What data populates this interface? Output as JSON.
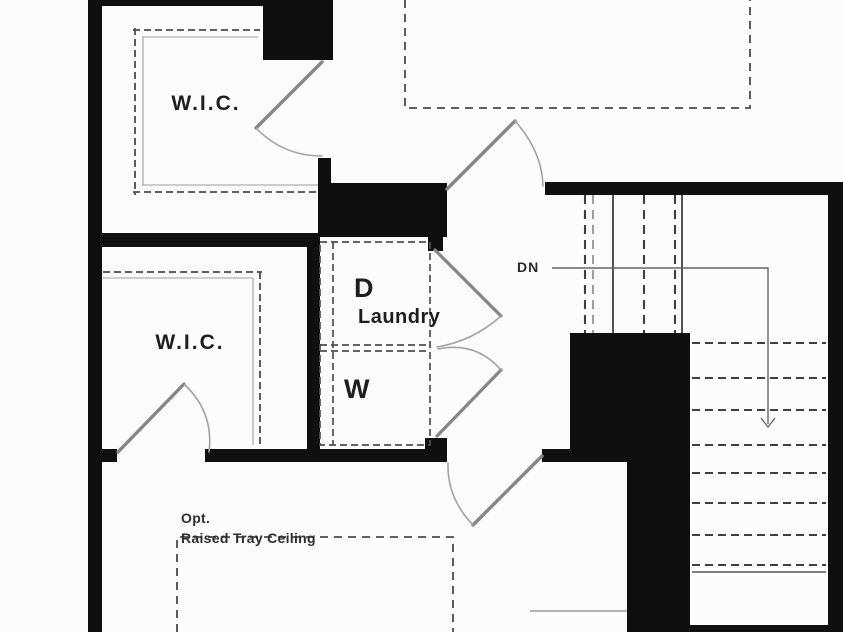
{
  "plan": {
    "type": "floor-plan-partial-second-floor",
    "labels": {
      "wic_top": "W.I.C.",
      "wic_mid": "W.I.C.",
      "dryer": "D",
      "laundry": "Laundry",
      "washer": "W",
      "down": "DN",
      "opt_line1": "Opt.",
      "opt_line2": "Raised Tray Ceiling"
    },
    "rooms": [
      {
        "name": "W.I.C.",
        "position": "top-left"
      },
      {
        "name": "W.I.C.",
        "position": "middle-left"
      },
      {
        "name": "Laundry",
        "appliances": [
          "D",
          "W"
        ]
      }
    ],
    "stairs": {
      "direction_label": "DN"
    },
    "notes": [
      "Opt. Raised Tray Ceiling"
    ],
    "colors": {
      "wall": "#0f0f0f",
      "background": "#fcfcfc",
      "dashed_feature": "#4a4a4a",
      "shelf_inner": "#b0b0b0",
      "door": "#8a8a8a",
      "door_swing": "#9e9e9e",
      "annotation_line": "#666666",
      "text": "#1e1e1e"
    }
  }
}
